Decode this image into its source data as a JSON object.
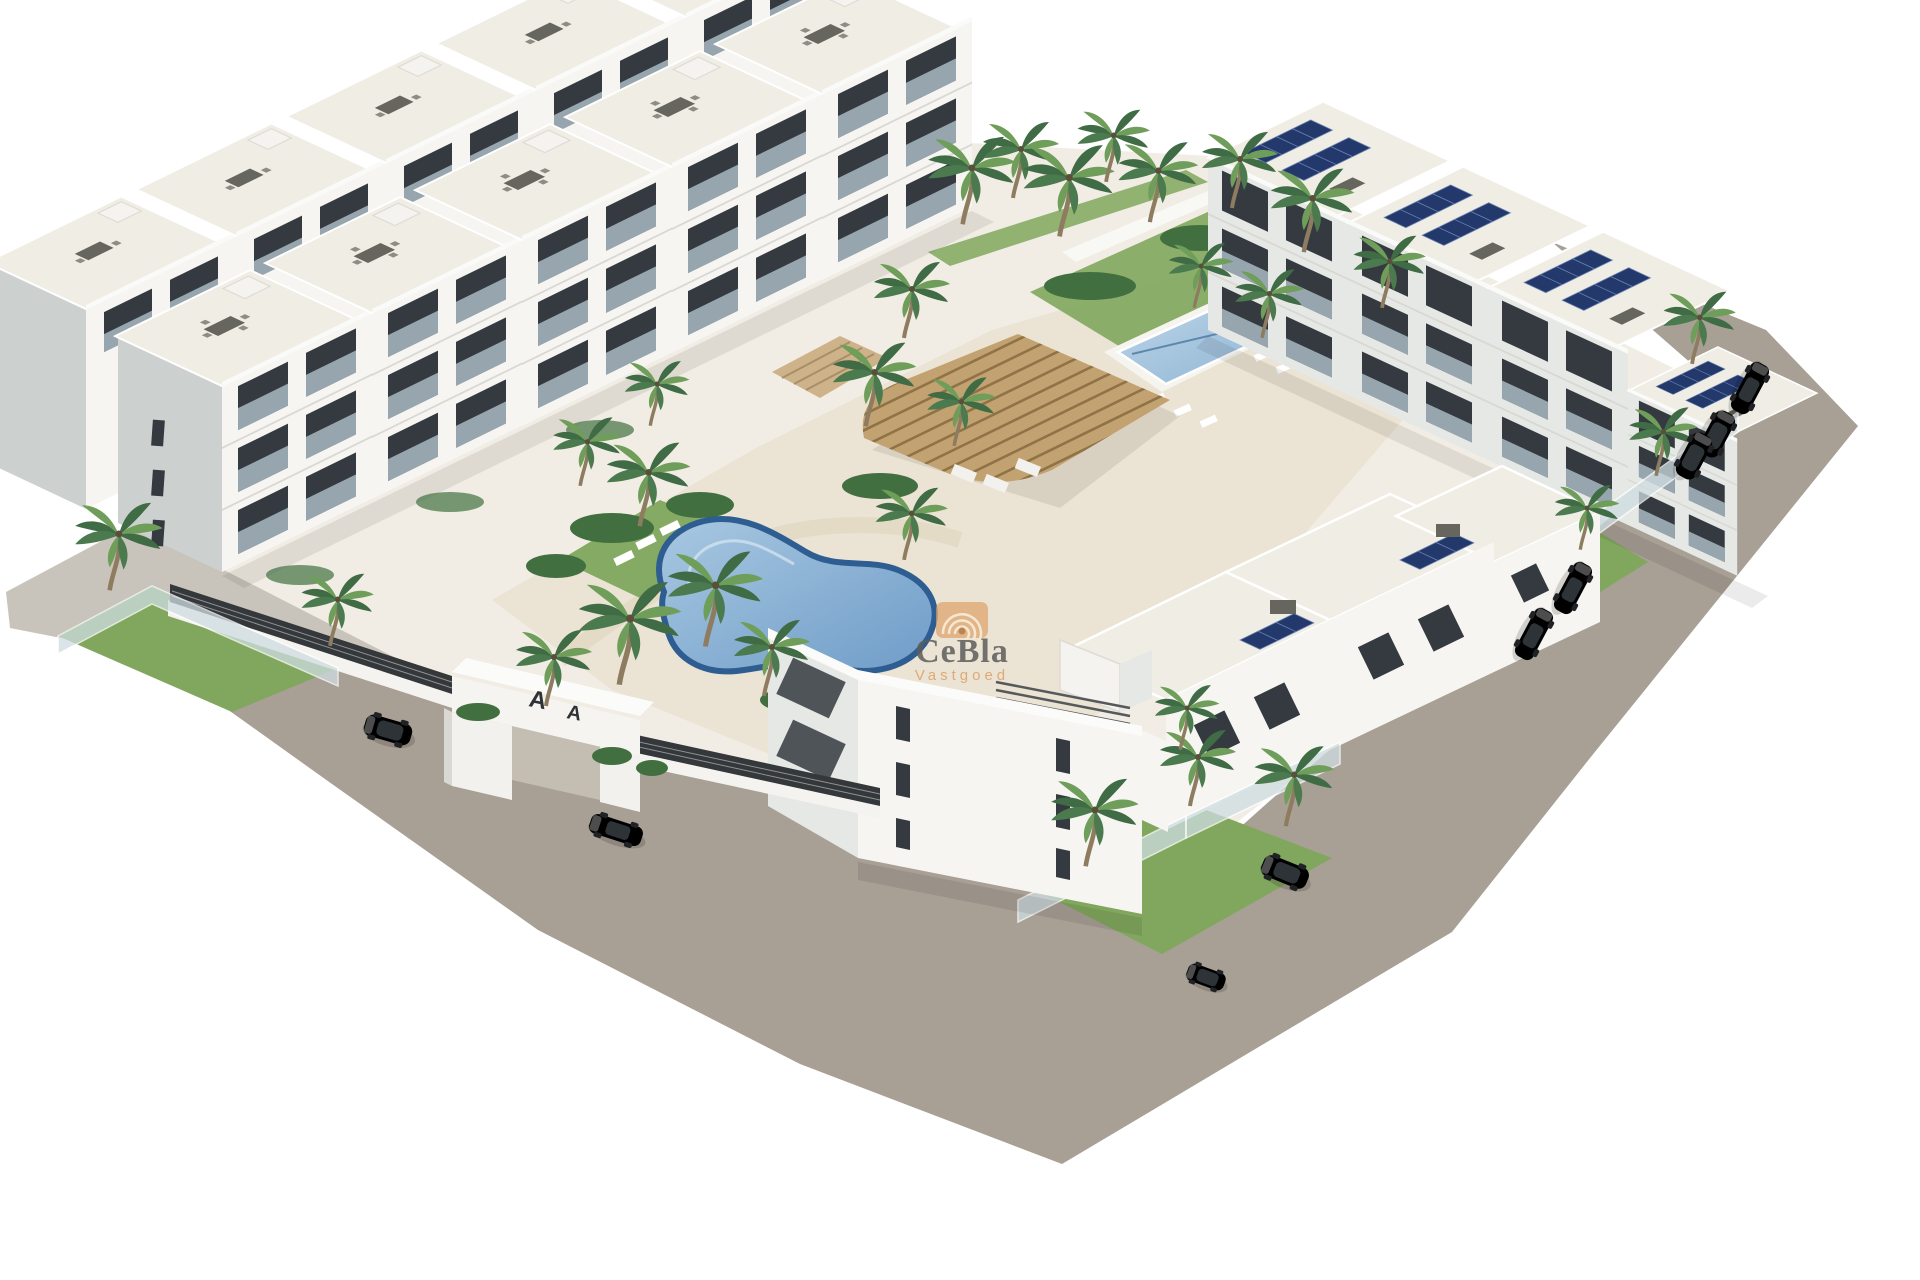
{
  "meta": {
    "type": "architectural-3d-render",
    "description": "Aerial view of a new-build white residential apartment complex with central kidney-shaped pool, rectangular lap pool, wooden pergola, palm trees, perimeter roads and parked cars on a white background"
  },
  "watermark": {
    "logo": "spiral-shell-icon",
    "brand": "CeBla",
    "tagline": "Vastgoed"
  },
  "gate": {
    "emblem": "A"
  },
  "scene": {
    "blocks": [
      {
        "name": "northwest-terraced-row",
        "features": "3-storey white apartments, roof terraces with dining tables, balconies"
      },
      {
        "name": "northeast-row",
        "features": "3-storey white apartments, rooftop solar panels, road-side gardens"
      },
      {
        "name": "southeast-row",
        "features": "3-storey white apartments, narrow window slits, glass-fenced gardens"
      }
    ],
    "pools": [
      {
        "name": "kidney-pool",
        "shape": "freeform kidney",
        "location": "central courtyard"
      },
      {
        "name": "lap-pool",
        "shape": "rectangular",
        "location": "upper courtyard"
      }
    ],
    "pergola": {
      "material": "wood slats",
      "location": "center courtyard"
    },
    "entrance": {
      "type": "white portal gate",
      "marks": "two dark A emblems",
      "location": "southwest street"
    },
    "palm_count": 30,
    "cars": [
      {
        "location": "right-road-top",
        "type": "hatchback",
        "color": "dark"
      },
      {
        "location": "right-road-upper",
        "type": "suv",
        "color": "white"
      },
      {
        "location": "right-road-upper-2",
        "type": "suv",
        "color": "gray"
      },
      {
        "location": "right-road-mid",
        "type": "sedan",
        "color": "dark"
      },
      {
        "location": "right-road-lower",
        "type": "sedan",
        "color": "silver"
      },
      {
        "location": "bottom-road",
        "type": "suv",
        "color": "brown"
      },
      {
        "location": "bottom-road-front",
        "type": "compact",
        "color": "white"
      },
      {
        "location": "gate-street",
        "type": "sedan",
        "color": "silver"
      },
      {
        "location": "left-street",
        "type": "suv",
        "color": "silver"
      }
    ]
  },
  "colors": {
    "background": "#ffffff",
    "road": "#a89f95",
    "road_light": "#c9c4bb",
    "base": "#f1ede4",
    "deck": "#ebe3d3",
    "building_white": "#f6f5f1",
    "building_shade": "#e6e8e5",
    "building_gable": "#ccd1d0",
    "roof": "#f0ede5",
    "window": "#343a3f",
    "glass": "#a9bac2",
    "lawn": "#80a75d",
    "hedge": "#426f40",
    "palm_dark": "#3f6b45",
    "palm_light": "#6f9d5a",
    "trunk": "#8d7c60",
    "pool_rim": "#2e5d92",
    "pool_water": "#7aa6cf",
    "pool_water_light": "#a8c8e1",
    "lap_pool": "#a3c4dc",
    "pergola": "#c3a271",
    "pergola_slat": "#8f7347",
    "solar": "#24396b",
    "fence": "#34383b",
    "car_silver": "#d2d4d6",
    "car_white": "#eceae6",
    "car_gray": "#96999c",
    "car_dark": "#43474b",
    "car_brown": "#4a4038",
    "watermark_orange": "#dfa066",
    "watermark_text": "#5c5c5c"
  }
}
